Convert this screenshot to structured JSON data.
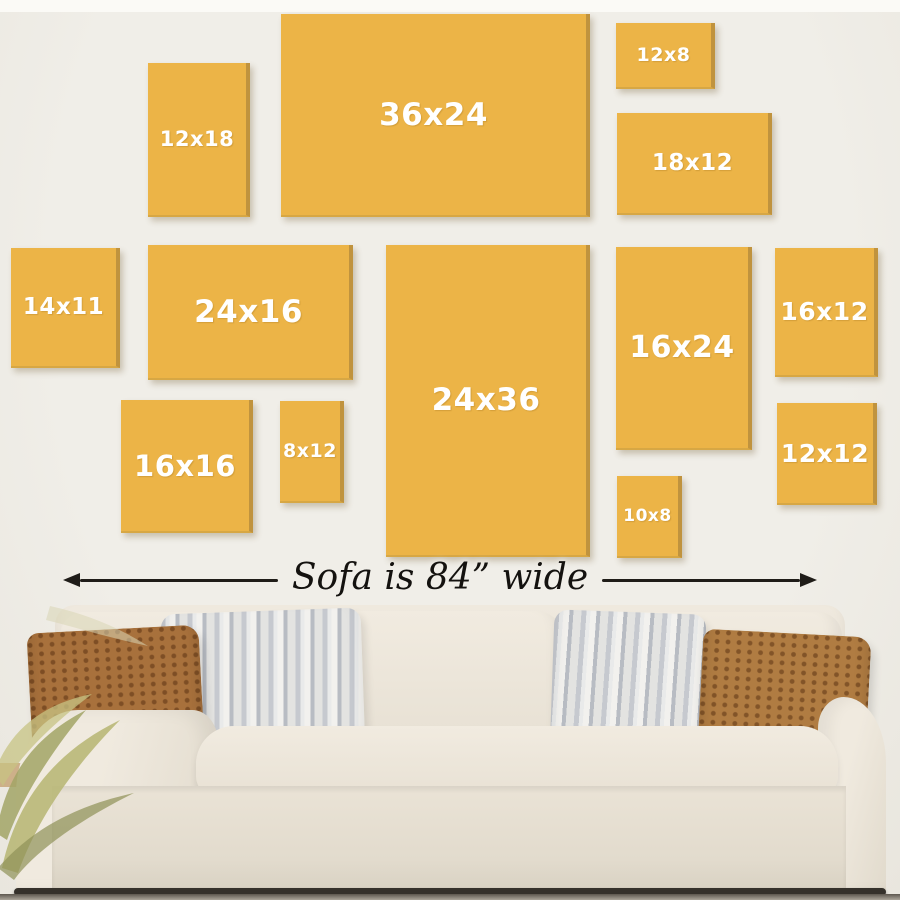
{
  "colors": {
    "wall": "#f0eee8",
    "wall-top": "#fbfaf6",
    "frame-fill": "#ecb447",
    "frame-edge": "#c0933e",
    "frame-text": "#ffffff",
    "arrow": "#1f1c18",
    "pillow-brown": "#a8713c",
    "floor-line": "#35312b"
  },
  "frames": [
    {
      "label": "12x18",
      "x": 148,
      "y": 63,
      "w": 102,
      "h": 154,
      "fs": 21
    },
    {
      "label": "36x24",
      "x": 281,
      "y": 14,
      "w": 309,
      "h": 203,
      "fs": 31
    },
    {
      "label": "12x8",
      "x": 616,
      "y": 23,
      "w": 99,
      "h": 66,
      "fs": 19
    },
    {
      "label": "18x12",
      "x": 617,
      "y": 113,
      "w": 155,
      "h": 102,
      "fs": 23
    },
    {
      "label": "14x11",
      "x": 11,
      "y": 248,
      "w": 109,
      "h": 120,
      "fs": 23
    },
    {
      "label": "24x16",
      "x": 148,
      "y": 245,
      "w": 205,
      "h": 135,
      "fs": 31
    },
    {
      "label": "24x36",
      "x": 386,
      "y": 245,
      "w": 204,
      "h": 312,
      "fs": 31
    },
    {
      "label": "16x24",
      "x": 616,
      "y": 247,
      "w": 136,
      "h": 203,
      "fs": 30
    },
    {
      "label": "16x12",
      "x": 775,
      "y": 248,
      "w": 103,
      "h": 129,
      "fs": 25
    },
    {
      "label": "12x12",
      "x": 777,
      "y": 403,
      "w": 100,
      "h": 102,
      "fs": 25
    },
    {
      "label": "16x16",
      "x": 121,
      "y": 400,
      "w": 132,
      "h": 133,
      "fs": 29
    },
    {
      "label": "8x12",
      "x": 280,
      "y": 401,
      "w": 64,
      "h": 102,
      "fs": 19
    },
    {
      "label": "10x8",
      "x": 617,
      "y": 476,
      "w": 65,
      "h": 82,
      "fs": 17
    }
  ],
  "dimension": {
    "label": "Sofa is 84” wide"
  },
  "icons": {
    "left_arrowhead": "triangle-left",
    "right_arrowhead": "triangle-right"
  }
}
